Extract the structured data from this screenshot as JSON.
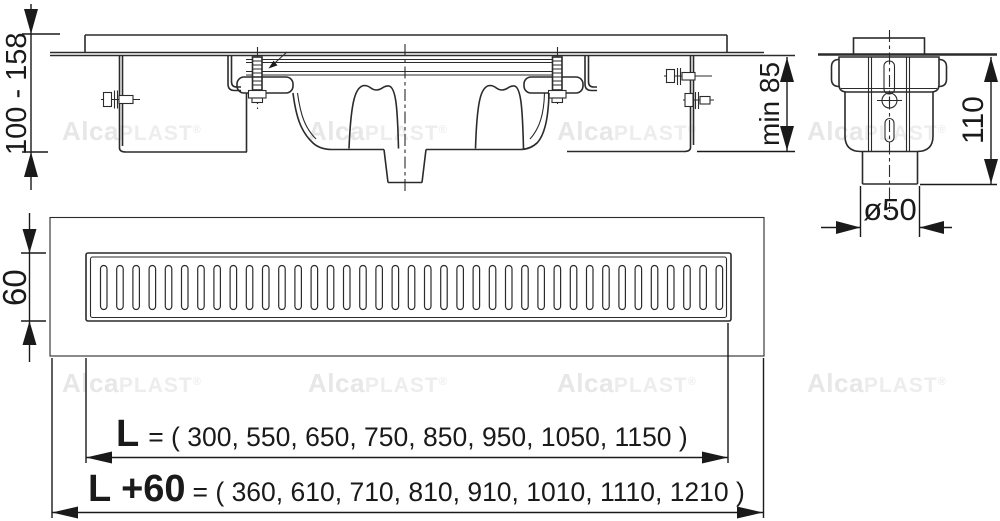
{
  "watermark": {
    "bold": "Alca",
    "light": "PLAST",
    "registered": "®"
  },
  "dimensions": {
    "install_height": "100 - 158",
    "min_depth": "min 85",
    "body_height": "110",
    "outlet_diameter": "ø50",
    "channel_width": "60"
  },
  "lengths": {
    "l_label": "L",
    "l_values": "= ( 300, 550, 650, 750, 850, 950, 1050, 1150 )",
    "l_plus_label": "L +60",
    "l_plus_values": "= ( 360, 610, 710, 810, 910, 1010, 1110, 1210 )"
  },
  "grate": {
    "slot_count": 39
  },
  "colors": {
    "line": "#2b2b2b",
    "dimension": "#1a1a1a",
    "watermark": "#e9e9e9",
    "background": "#ffffff"
  }
}
